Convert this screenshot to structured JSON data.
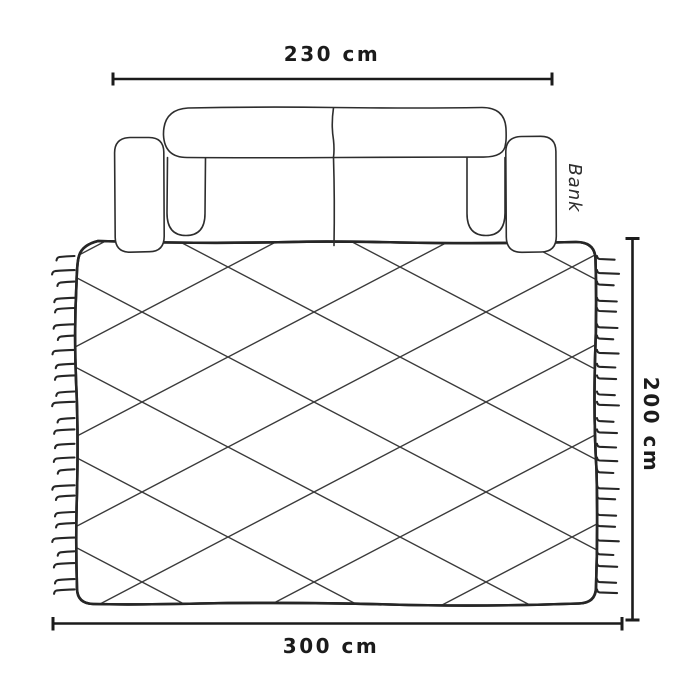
{
  "diagram": {
    "sofa": {
      "label": "Bank"
    },
    "dimensions": {
      "sofa_width": {
        "label": "230 cm"
      },
      "rug_length": {
        "label": "300 cm"
      },
      "rug_width": {
        "label": "200 cm"
      }
    },
    "colors": {
      "line": "#2d2d2d",
      "dimension_line": "#1b1b1b",
      "lattice": "#3a3a3a",
      "background": "#ffffff"
    }
  }
}
